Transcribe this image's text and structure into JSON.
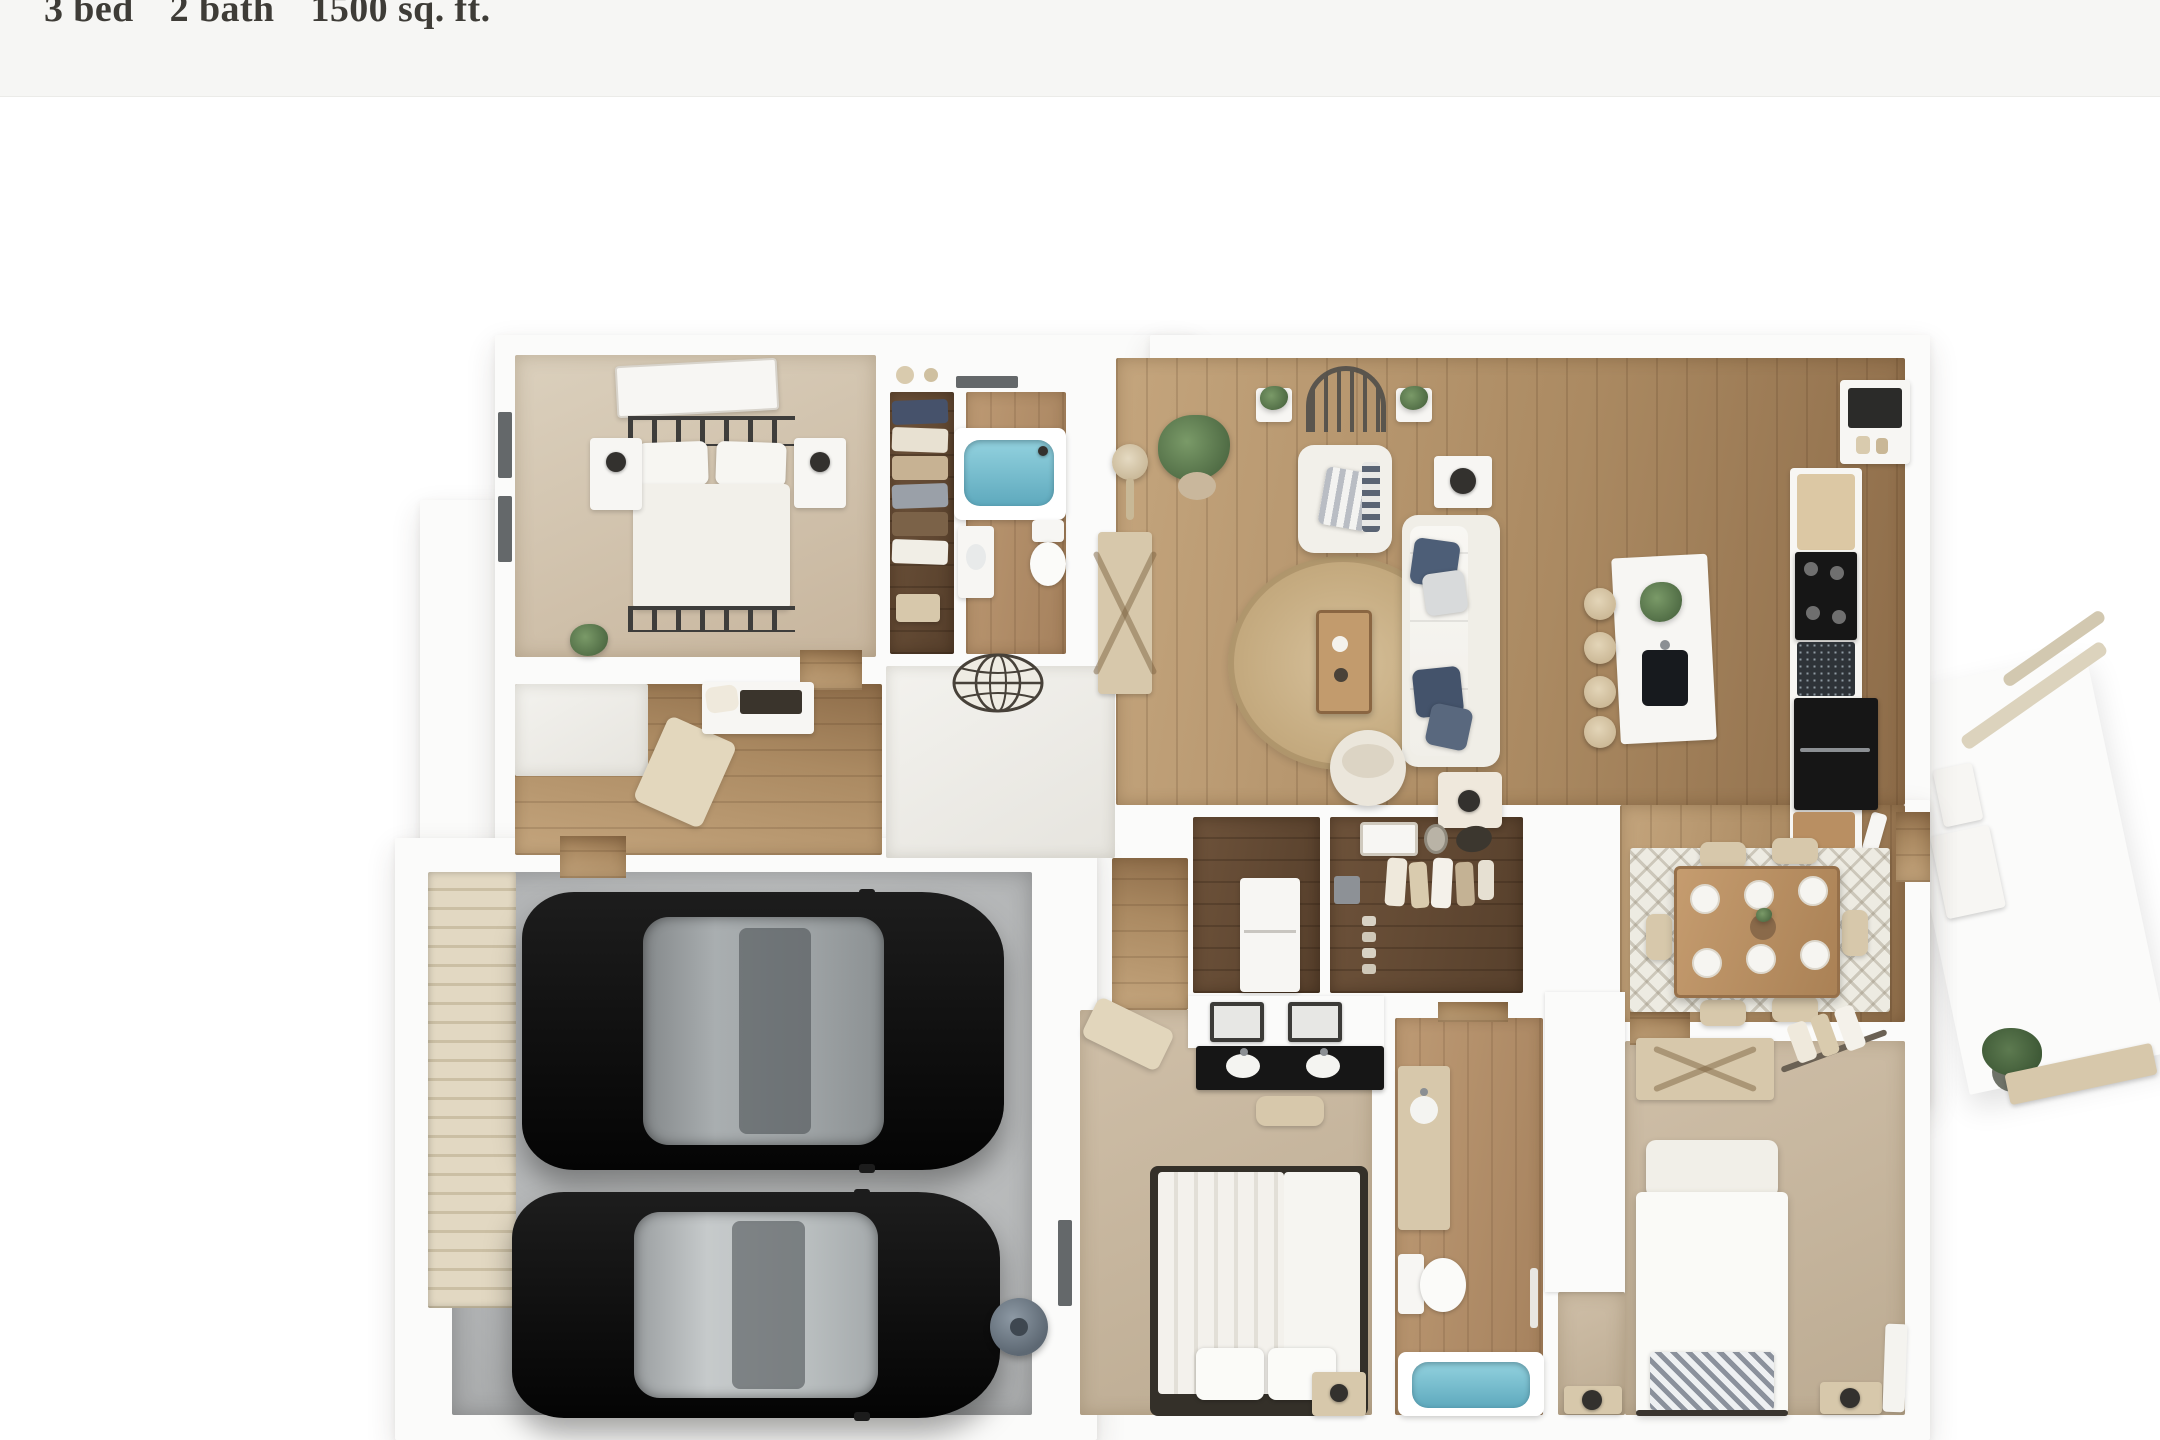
{
  "header": {
    "stats": [
      {
        "label": "3 bed"
      },
      {
        "label": "2 bath"
      },
      {
        "label": "1500 sq. ft."
      }
    ]
  },
  "floor_plan": {
    "type": "3d-top-down-floor-plan-render",
    "rooms": [
      {
        "name": "bedroom-2",
        "floor": "carpet",
        "furniture": [
          "metal-frame-double-bed",
          "pillows",
          "nightstand-left",
          "nightstand-right",
          "table-lamps",
          "wall-art",
          "potted-plant",
          "two-windows"
        ]
      },
      {
        "name": "hall-closet",
        "floor": "dark-wood",
        "furniture": [
          "hanging-clothes",
          "shelf-with-baskets",
          "storage-box"
        ]
      },
      {
        "name": "bathroom-2",
        "floor": "wood",
        "furniture": [
          "bathtub",
          "toilet",
          "vanity-sink",
          "window"
        ]
      },
      {
        "name": "hallway",
        "floor": "wood",
        "furniture": [
          "desk-with-chair",
          "angled-bench",
          "round-world-rug"
        ]
      },
      {
        "name": "living-room",
        "floor": "hardwood",
        "furniture": [
          "sofa-with-blue-pillows",
          "armchair",
          "coffee-table",
          "round-jute-rug",
          "swivel-pouf",
          "console-table",
          "floor-lamp",
          "potted-plant",
          "side-table-with-lamp",
          "end-table-with-lamp",
          "arched-window-decor",
          "plant-niches"
        ]
      },
      {
        "name": "kitchen",
        "floor": "hardwood",
        "furniture": [
          "island-with-sink",
          "island-plant",
          "four-bar-stools",
          "counter-run",
          "cutting-board",
          "black-cooktop",
          "granite-sink-section",
          "black-refrigerator",
          "wood-block",
          "pantry-shelf"
        ]
      },
      {
        "name": "dining-area",
        "floor": "hardwood",
        "furniture": [
          "wood-dining-table",
          "six-place-settings",
          "centerpiece",
          "six-chairs",
          "patterned-rug"
        ]
      },
      {
        "name": "laundry",
        "floor": "dark-wood",
        "furniture": [
          "white-appliance"
        ]
      },
      {
        "name": "walk-in-closet",
        "floor": "dark-wood",
        "furniture": [
          "hanging-clothes",
          "wall-mirror",
          "shelf-frame",
          "gray-box",
          "shoe-stack"
        ]
      },
      {
        "name": "master-bedroom",
        "floor": "carpet",
        "furniture": [
          "striped-duvet-bed",
          "pillows",
          "nightstand-with-lamp",
          "dual-sink-black-vanity",
          "two-mirrors",
          "vanity-stool",
          "angled-bench",
          "window"
        ]
      },
      {
        "name": "master-bathroom",
        "floor": "wood",
        "furniture": [
          "bathtub",
          "toilet",
          "vanity-sink",
          "towel-rail"
        ]
      },
      {
        "name": "bedroom-3",
        "floor": "carpet",
        "furniture": [
          "bed-with-headboard",
          "herringbone-throw",
          "dresser-x-front",
          "hanging-rod-with-clothes",
          "nightstand-left",
          "nightstand-right",
          "table-lamps",
          "window-curtain"
        ]
      },
      {
        "name": "garage",
        "floor": "concrete",
        "furniture": [
          "black-car-top",
          "black-car-bottom",
          "water-heater",
          "ribbed-garage-door"
        ]
      },
      {
        "name": "entry-porch",
        "floor": "white-slab",
        "furniture": [
          "railing-bars",
          "porch-chair",
          "hook-board",
          "potted-plant",
          "bench",
          "entry-door"
        ]
      }
    ]
  },
  "colors": {
    "header_bg": "#f6f6f4",
    "title_color": "#3e3c37",
    "wall": "#fbfbfa",
    "wood": "#ab8a62",
    "wood_light": "#c4a57d",
    "wood_dark": "#8d6c49",
    "carpet": "#d4c8b4",
    "carpet2": "#c9b8a1",
    "tile": "#f2f1ed",
    "concrete": "#b9bbbc",
    "tub": "#72b8cb",
    "beige": "#d7c8ab",
    "beige_dark": "#b9a585",
    "black": "#161616",
    "glass": "#a9aeb0",
    "glass_light": "#c6cacb",
    "navy": "#4d5e77",
    "green": "#5f7d52",
    "jute": "#c9b188",
    "rug_light": "#edebe2",
    "garage_door": "#ddd2bb"
  }
}
